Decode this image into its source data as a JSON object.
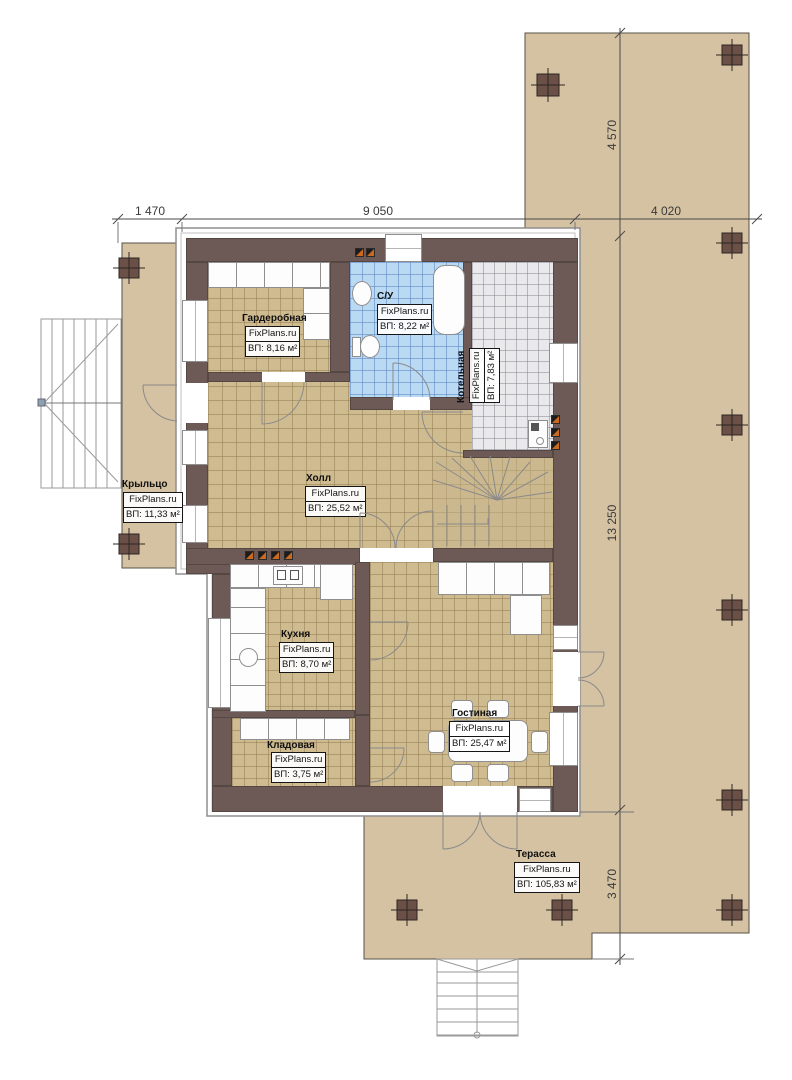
{
  "brand": "FixPlans.ru",
  "rooms": [
    {
      "id": "wardrobe",
      "name": "Гардеробная",
      "brand": "FixPlans.ru",
      "area": "ВП: 8,16 м²"
    },
    {
      "id": "bathroom",
      "name": "С/У",
      "brand": "FixPlans.ru",
      "area": "ВП: 8,22 м²"
    },
    {
      "id": "boiler",
      "name": "Котельная",
      "brand": "FixPlans.ru",
      "area": "ВП: 7,83 м²"
    },
    {
      "id": "hall",
      "name": "Холл",
      "brand": "FixPlans.ru",
      "area": "ВП: 25,52 м²"
    },
    {
      "id": "porch",
      "name": "Крыльцо",
      "brand": "FixPlans.ru",
      "area": "ВП: 11,33 м²"
    },
    {
      "id": "kitchen",
      "name": "Кухня",
      "brand": "FixPlans.ru",
      "area": "ВП: 8,70 м²"
    },
    {
      "id": "pantry",
      "name": "Кладовая",
      "brand": "FixPlans.ru",
      "area": "ВП: 3,75 м²"
    },
    {
      "id": "living",
      "name": "Гостиная",
      "brand": "FixPlans.ru",
      "area": "ВП: 25,47 м²"
    },
    {
      "id": "terrace",
      "name": "Терасса",
      "brand": "FixPlans.ru",
      "area": "ВП: 105,83 м²"
    }
  ],
  "dims": {
    "top": [
      "1 470",
      "9 050",
      "4 020"
    ],
    "right": [
      "4 570",
      "13 250",
      "3 470"
    ]
  },
  "colors": {
    "terrace_beige": "#d4c2a2",
    "wall_brown": "#6d5a56",
    "floor_tan": "#cfbb90",
    "bath_blue": "#bad9f3",
    "boiler_gray": "#e9e9eb",
    "radiator_orange": "#c96a20",
    "column_brown": "#6b5048"
  }
}
